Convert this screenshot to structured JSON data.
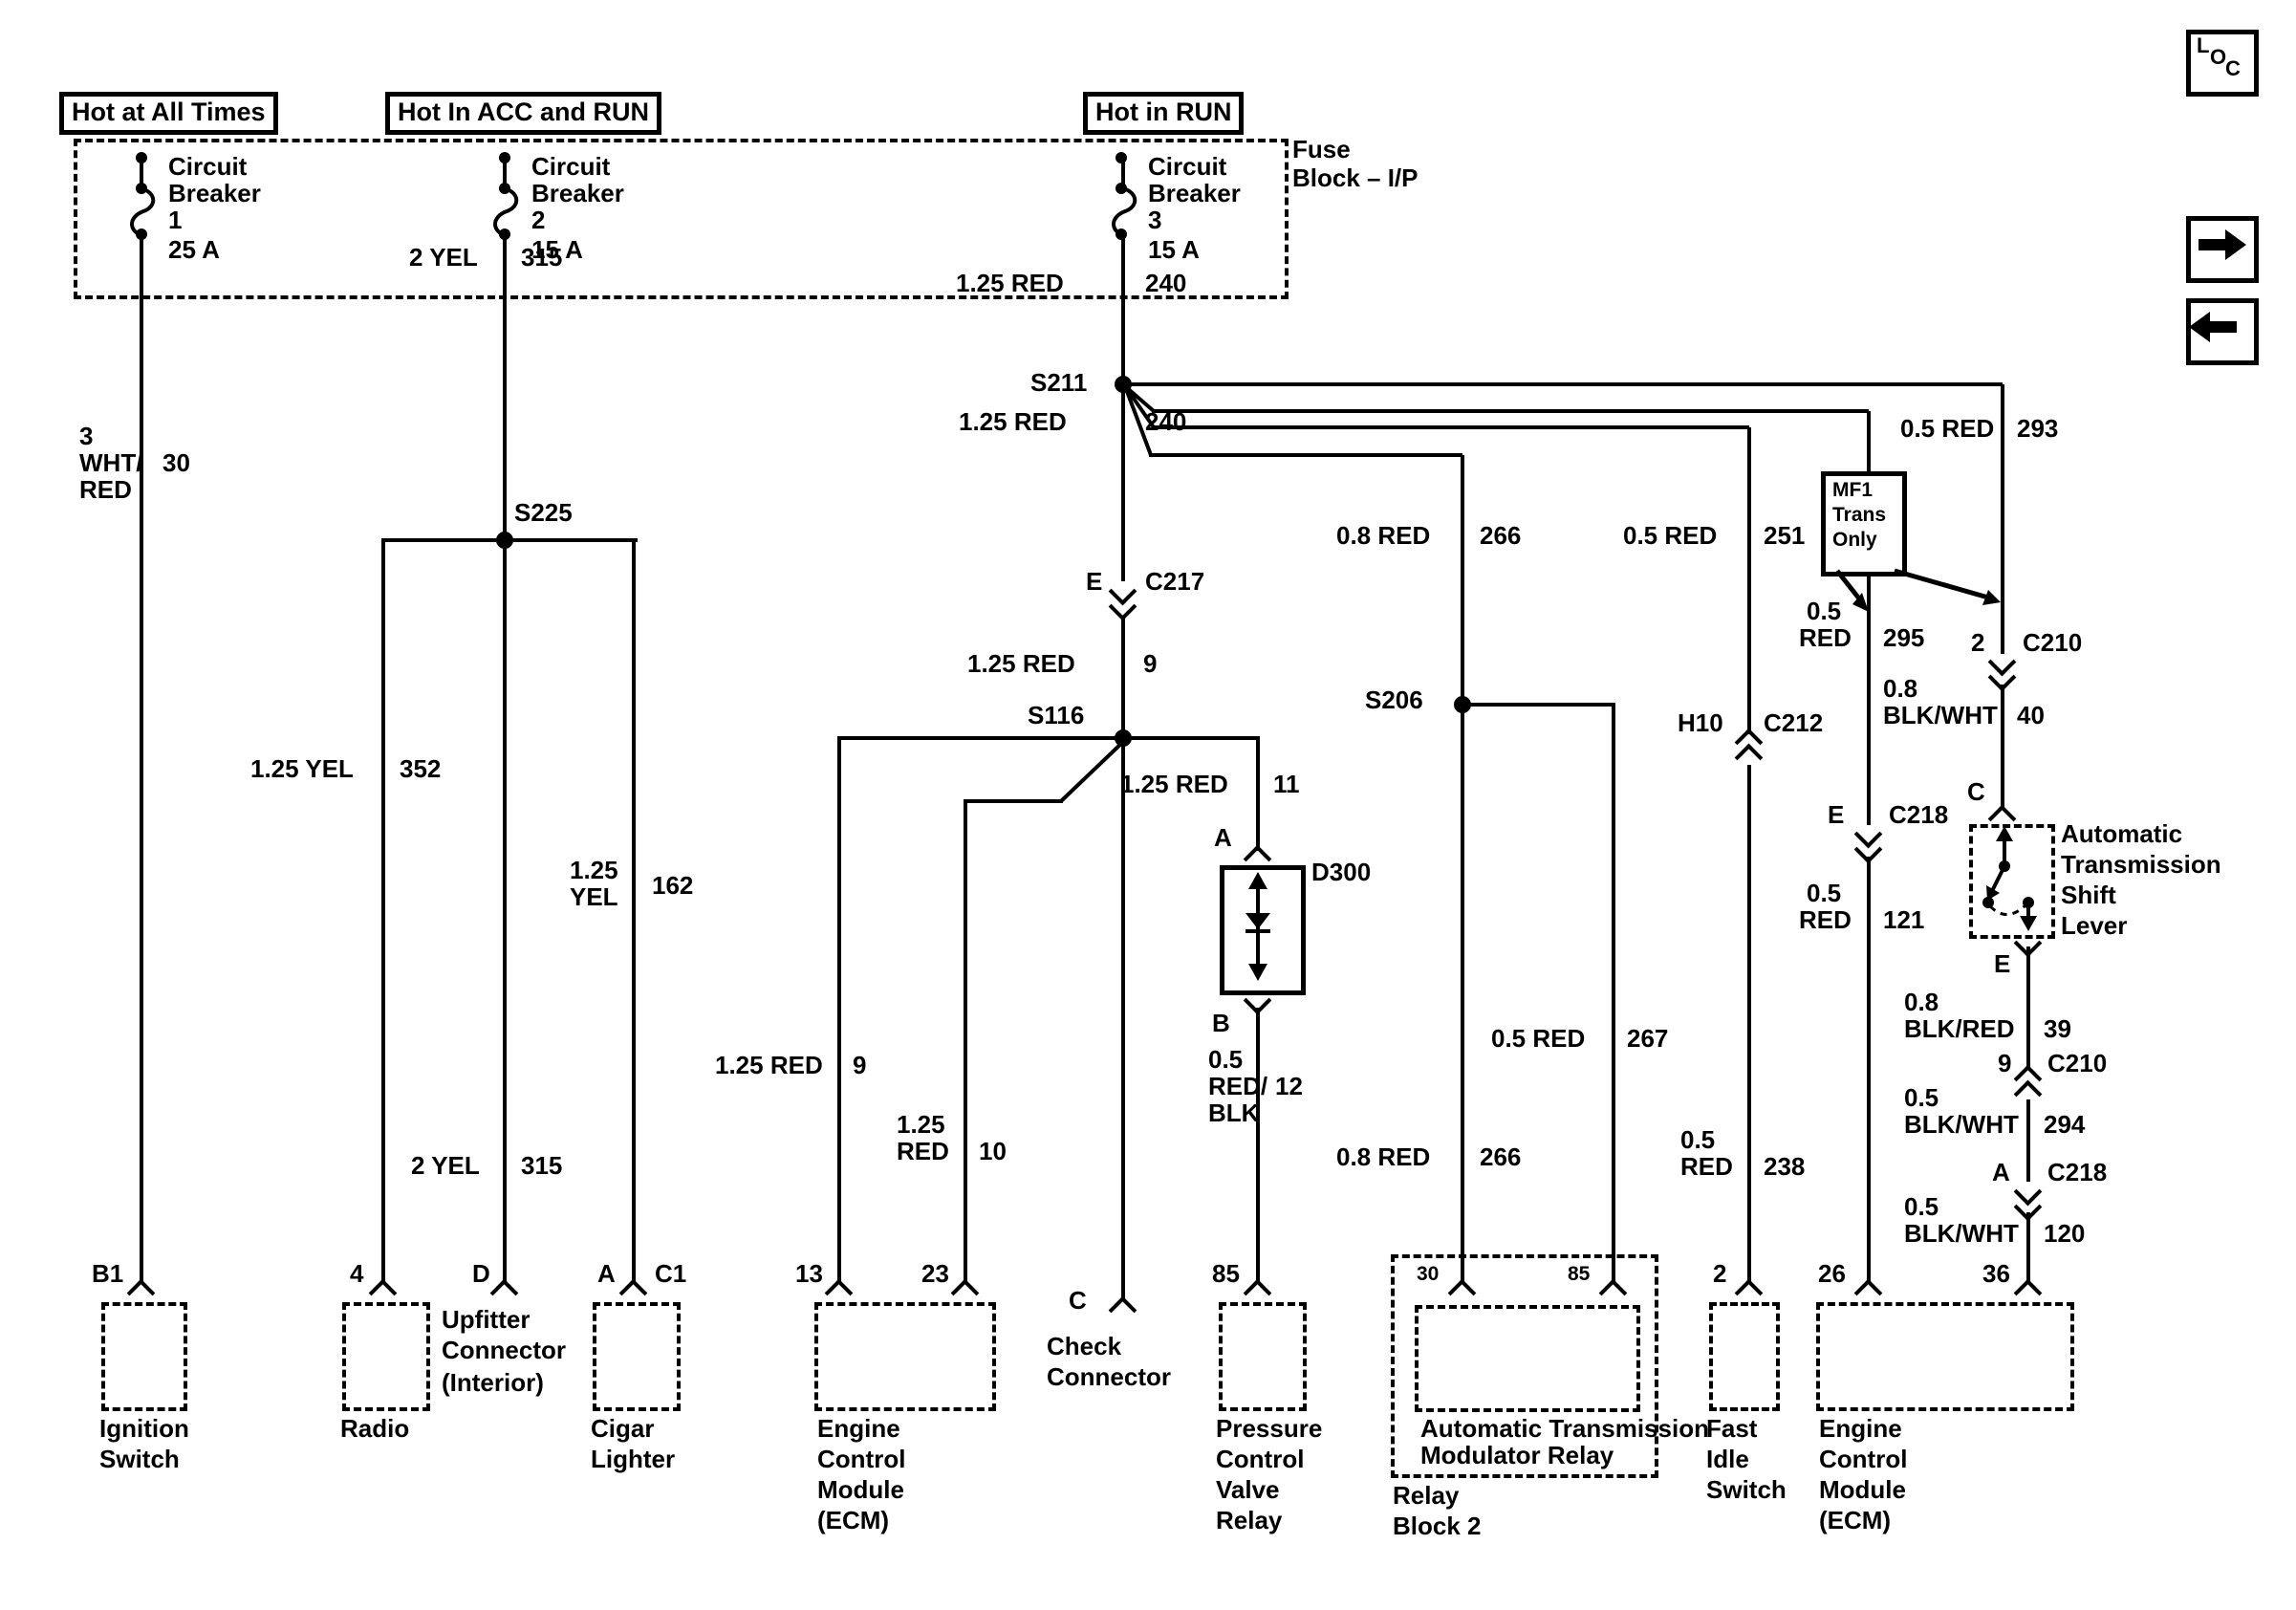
{
  "legend": {
    "l": "L",
    "o": "O",
    "c": "C"
  },
  "power_tags": [
    "Hot at All Times",
    "Hot In ACC and RUN",
    "Hot in RUN"
  ],
  "fuse_block": {
    "line1": "Fuse",
    "line2": "Block – I/P"
  },
  "breakers": [
    {
      "l1": "Circuit",
      "l2": "Breaker",
      "l3": "1",
      "l4": "25 A"
    },
    {
      "l1": "Circuit",
      "l2": "Breaker",
      "l3": "2",
      "l4": "15 A"
    },
    {
      "l1": "Circuit",
      "l2": "Breaker",
      "l3": "3",
      "l4": "15 A"
    }
  ],
  "splices": {
    "s211": "S211",
    "s225": "S225",
    "s116": "S116",
    "s206": "S206"
  },
  "connectors": {
    "c217": {
      "pin": "E",
      "name": "C217"
    },
    "c212": {
      "pin": "H10",
      "name": "C212"
    },
    "c218_e": {
      "pin": "E",
      "name": "C218"
    },
    "c218_a": {
      "pin": "A",
      "name": "C218"
    },
    "c210_2": {
      "pin": "2",
      "name": "C210"
    },
    "c210_9": {
      "pin": "9",
      "name": "C210"
    }
  },
  "mf1": {
    "line1": "MF1",
    "line2": "Trans",
    "line3": "Only"
  },
  "wires": {
    "w30": {
      "a": "3",
      "b": "WHT/",
      "c": "RED",
      "n": "30"
    },
    "w315_top": {
      "a": "2 YEL",
      "n": "315"
    },
    "w352": {
      "a": "1.25 YEL",
      "n": "352"
    },
    "w162": {
      "a": "1.25",
      "b": "YEL",
      "n": "162"
    },
    "w315_bot": {
      "a": "2 YEL",
      "n": "315"
    },
    "w240_top": {
      "a": "1.25 RED",
      "n": "240"
    },
    "w240_mid": {
      "a": "1.25 RED",
      "n": "240"
    },
    "w9_mid": {
      "a": "1.25 RED",
      "n": "9"
    },
    "w9_ecm": {
      "a": "1.25 RED",
      "n": "9"
    },
    "w10": {
      "a": "1.25",
      "b": "RED",
      "n": "10"
    },
    "w11": {
      "a": "1.25 RED",
      "n": "11"
    },
    "w12": {
      "a": "0.5",
      "b": "RED/",
      "c": "BLK",
      "n": "12"
    },
    "w266_top": {
      "a": "0.8 RED",
      "n": "266"
    },
    "w266_bot": {
      "a": "0.8 RED",
      "n": "266"
    },
    "w267": {
      "a": "0.5 RED",
      "n": "267"
    },
    "w251": {
      "a": "0.5 RED",
      "n": "251"
    },
    "w238": {
      "a": "0.5",
      "b": "RED",
      "n": "238"
    },
    "w295": {
      "a": "0.5",
      "b": "RED",
      "n": "295"
    },
    "w121": {
      "a": "0.5",
      "b": "RED",
      "n": "121"
    },
    "w293": {
      "a": "0.5 RED",
      "n": "293"
    },
    "w40": {
      "a": "0.8",
      "b": "BLK/WHT",
      "n": "40"
    },
    "w39": {
      "a": "0.8",
      "b": "BLK/RED",
      "n": "39"
    },
    "w294": {
      "a": "0.5",
      "b": "BLK/WHT",
      "n": "294"
    },
    "w120": {
      "a": "0.5",
      "b": "BLK/WHT",
      "n": "120"
    }
  },
  "components": {
    "ignition": {
      "pin": "B1",
      "lines": [
        "Ignition",
        "Switch"
      ]
    },
    "radio": {
      "pin": "4",
      "lines": [
        "Radio"
      ]
    },
    "upfitter": {
      "pin": "D",
      "lines": [
        "Upfitter",
        "Connector"
      ],
      "note": "(Interior)"
    },
    "cigar": {
      "pinA": "A",
      "pinB": "C1",
      "lines": [
        "Cigar",
        "Lighter"
      ]
    },
    "ecm_left": {
      "pin1": "13",
      "pin2": "23",
      "lines": [
        "Engine",
        "Control",
        "Module",
        "(ECM)"
      ]
    },
    "check": {
      "pin": "C",
      "lines": [
        "Check",
        "Connector"
      ]
    },
    "pcv": {
      "pin": "85",
      "lines": [
        "Pressure",
        "Control",
        "Valve",
        "Relay"
      ]
    },
    "relay_block": {
      "pin1": "30",
      "pin2": "85",
      "inner1": "Automatic Transmission",
      "inner2": "Modulator Relay",
      "lines": [
        "Relay",
        "Block 2"
      ]
    },
    "fast_idle": {
      "pin": "2",
      "lines": [
        "Fast",
        "Idle",
        "Switch"
      ]
    },
    "ecm_right": {
      "pin1": "26",
      "pin2": "36",
      "lines": [
        "Engine",
        "Control",
        "Module",
        "(ECM)"
      ]
    },
    "shift": {
      "pinC": "C",
      "pinE": "E",
      "lines": [
        "Automatic",
        "Transmission",
        "Shift",
        "Lever"
      ]
    },
    "d300": {
      "pinA": "A",
      "pinB": "B",
      "name": "D300"
    }
  }
}
